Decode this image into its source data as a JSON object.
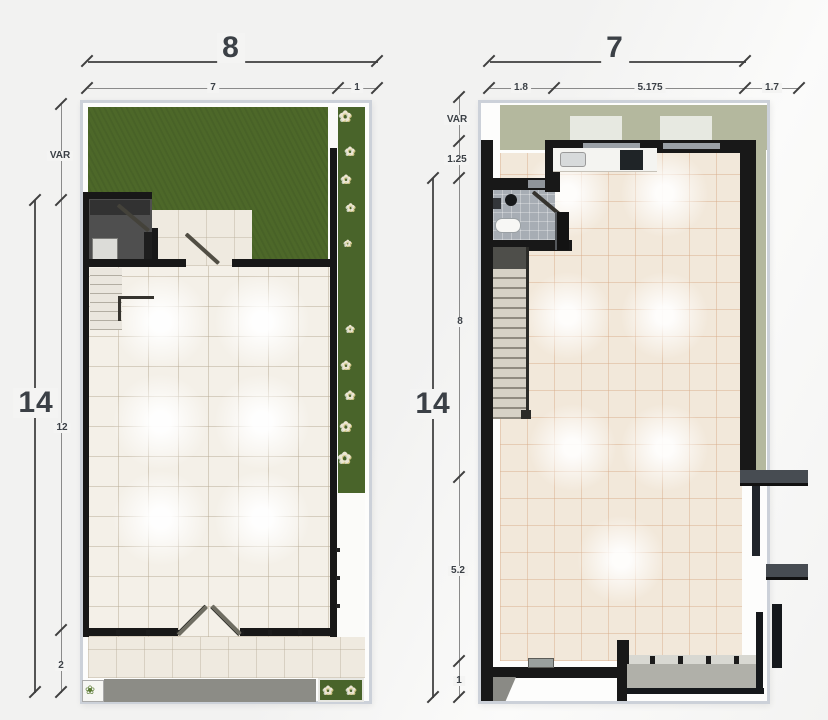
{
  "left_plan": {
    "top_dim": {
      "overall": "8",
      "segments": [
        "7",
        "1"
      ]
    },
    "side_dim": {
      "overall": "14",
      "segments": [
        "VAR",
        "12",
        "2"
      ]
    }
  },
  "right_plan": {
    "top_dim": {
      "overall": "7",
      "segments": [
        "1.8",
        "5.175",
        "1.7"
      ]
    },
    "side_dim": {
      "overall": "14",
      "segments": [
        "VAR",
        "1.25",
        "8",
        "5.2",
        "1"
      ]
    }
  },
  "icons": {
    "flower_glyph": "✿",
    "shrub_glyph": "❀"
  },
  "colors": {
    "page_bg": "#f4f4f3",
    "plan_border": "#ccd1d9",
    "wall": "#181818",
    "lawn": "#4d6829",
    "plant_bed": "#49642a",
    "tile_left": "#f4f0e8",
    "tile_right": "#f2e8da",
    "patio": "#efeae0",
    "sage": "#b4b89e",
    "skylight": "#e7e9e1",
    "walkway": "#8c8c86",
    "bath_dark": "#4f4f4f",
    "bath_gray": "#a7adb4",
    "fin": "#474c52",
    "ledge": "#b0b0a9",
    "dim_line": "#555555",
    "dim_text": "#3b4046"
  }
}
